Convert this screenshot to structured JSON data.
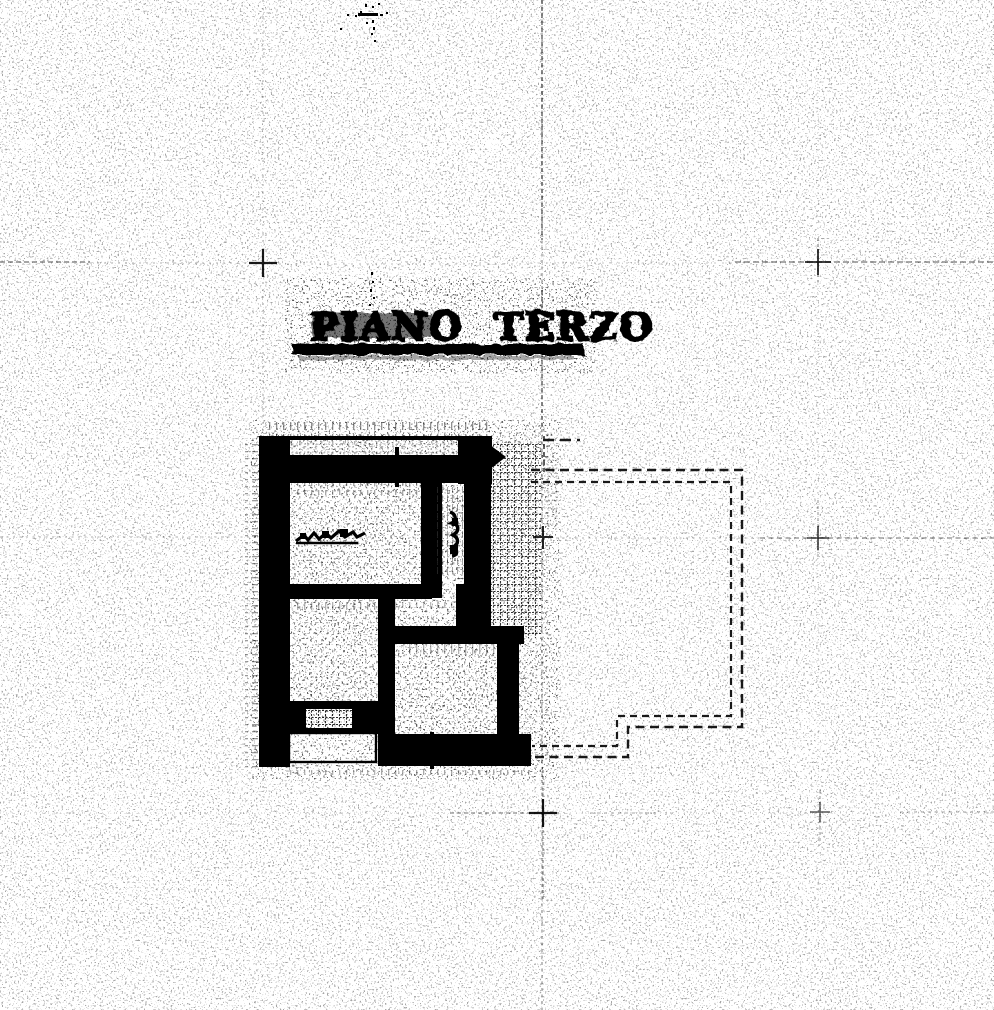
{
  "document": {
    "title": "PIANO TERZO"
  },
  "colors": {
    "paper": "#ffffff",
    "ink": "#000000",
    "grid": "#3c3c3c"
  },
  "drawing": {
    "regions": [
      "solid-unit-floorplan",
      "hatched-terrace",
      "dashed-building-outline",
      "survey-grid",
      "balcony",
      "stairwell"
    ]
  }
}
